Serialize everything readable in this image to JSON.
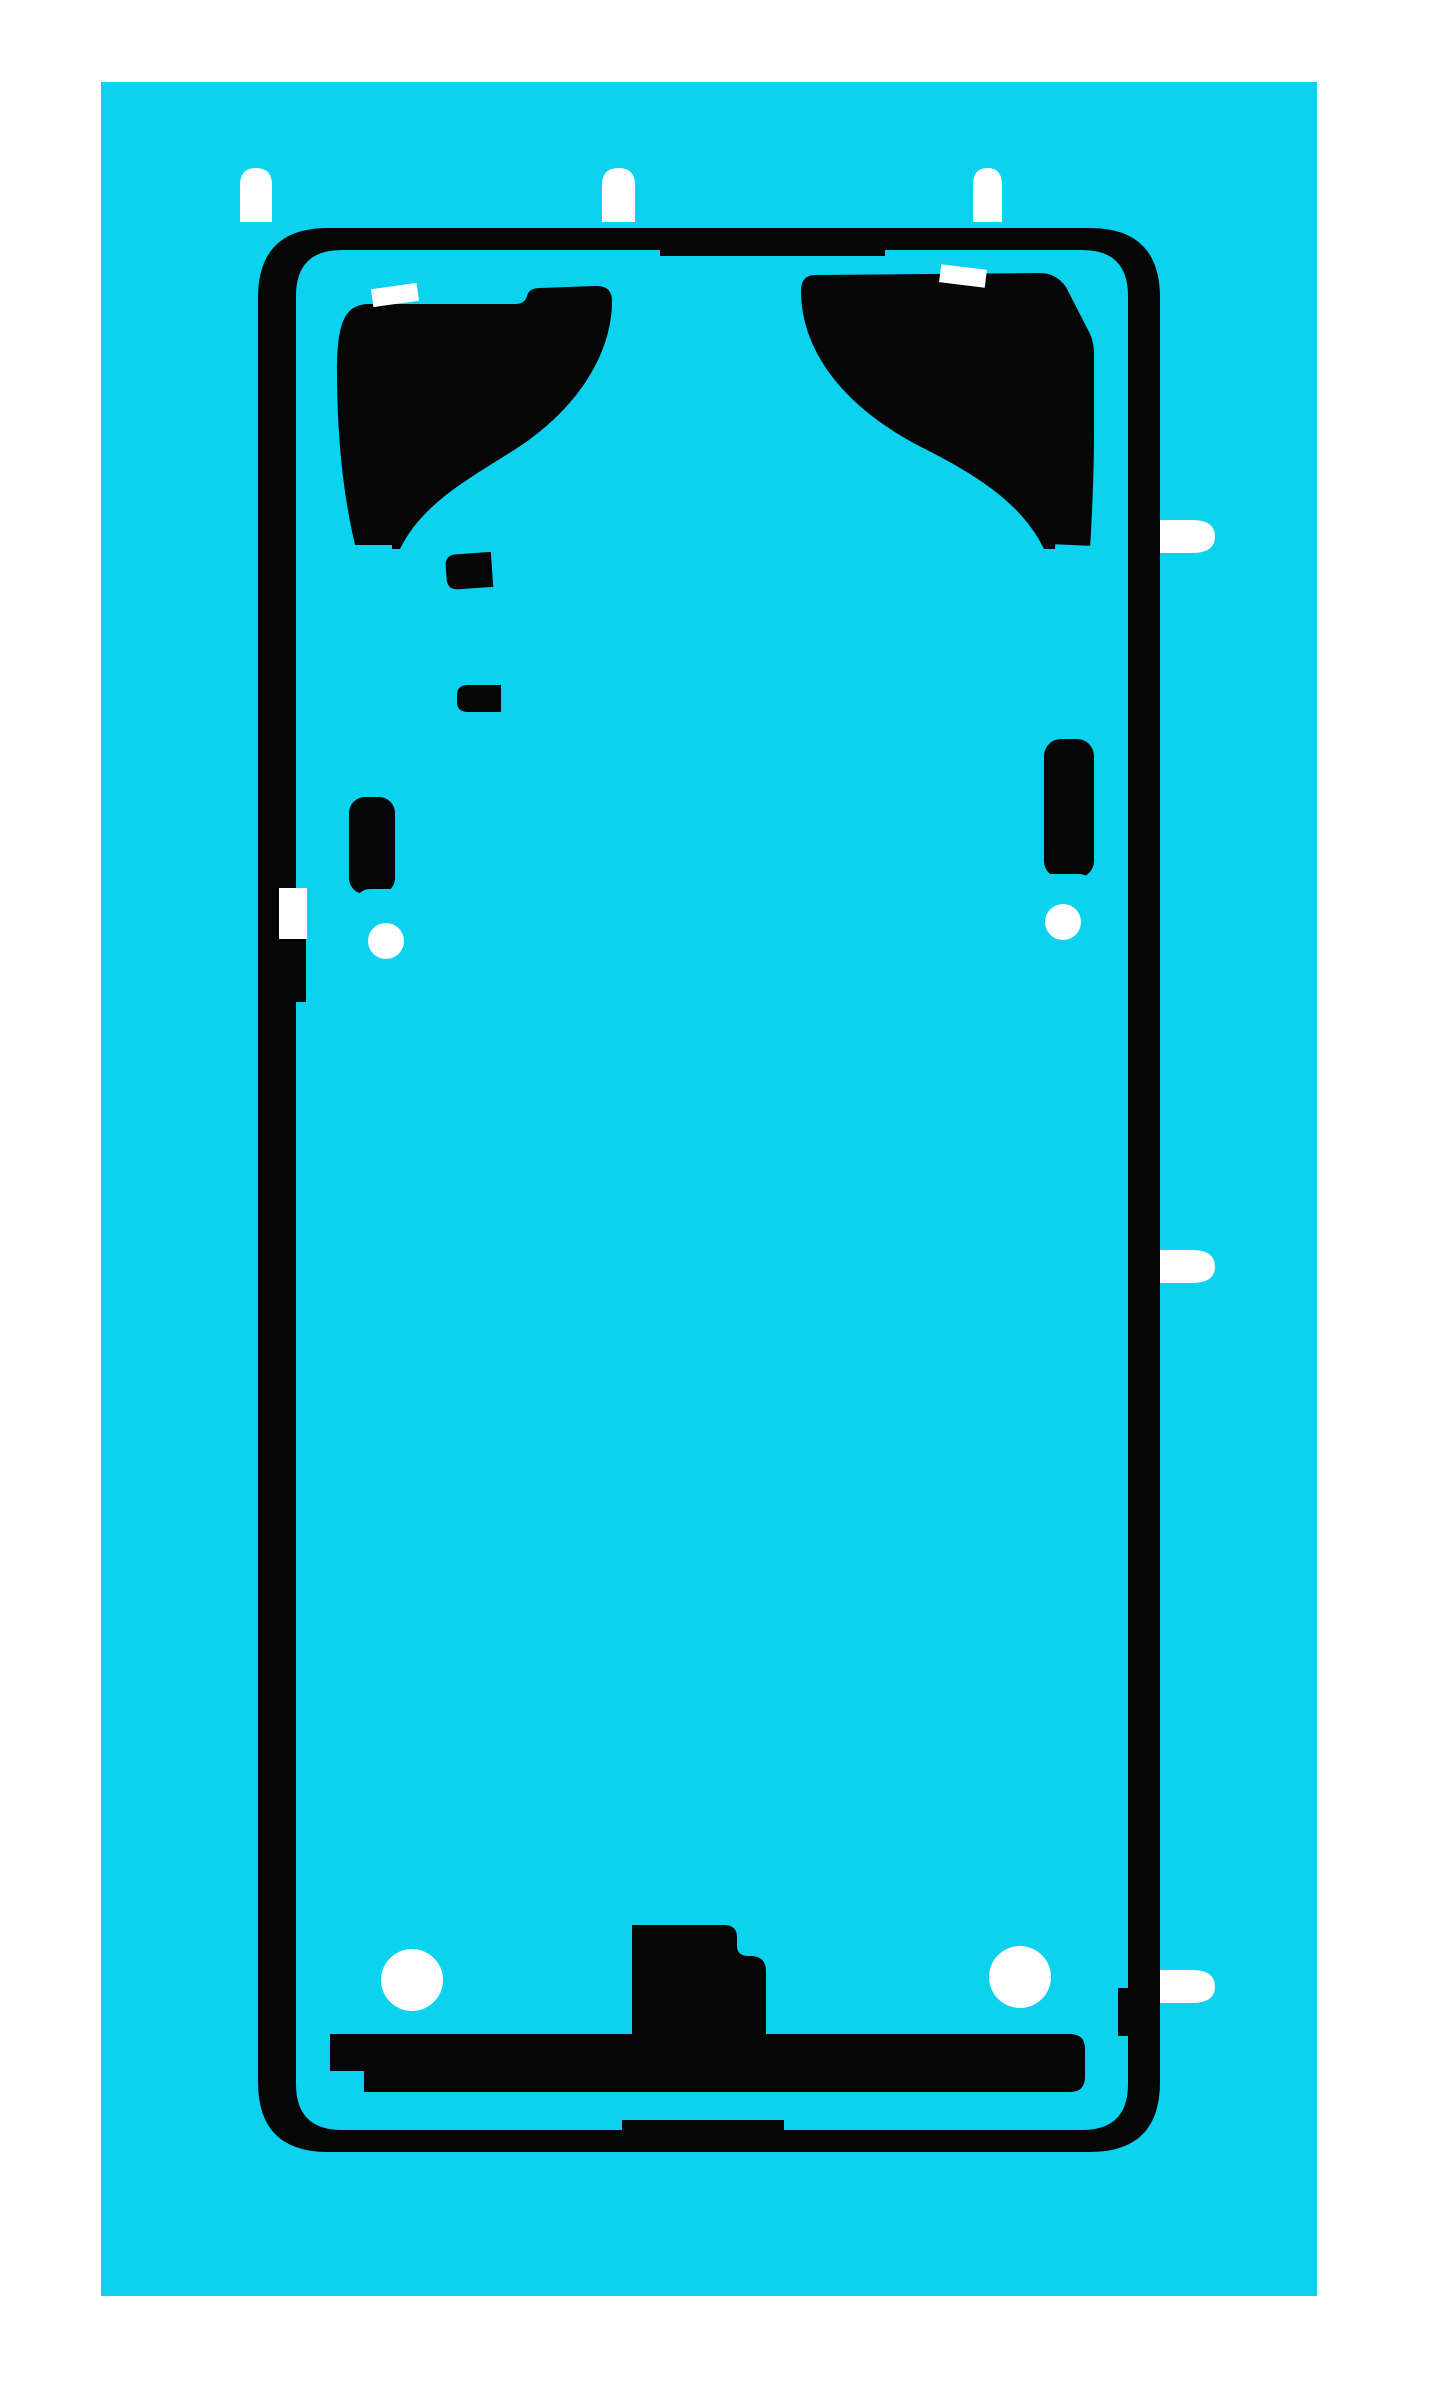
{
  "scene": {
    "type": "product-photo",
    "subject": "Pre-cut smartphone back-cover adhesive sticker sheet on a cyan release liner",
    "visible_text": "",
    "colors": {
      "page_background": "#FFFFFF",
      "liner": "#0BD2EE",
      "adhesive": "#060606",
      "cutout": "#FFFFFF"
    },
    "counts": {
      "top_alignment_tabs": "3",
      "right_alignment_tabs": "3",
      "upper_screw_holes": "2",
      "bottom_screw_holes": "2",
      "inner_pull_strips": "2"
    }
  }
}
